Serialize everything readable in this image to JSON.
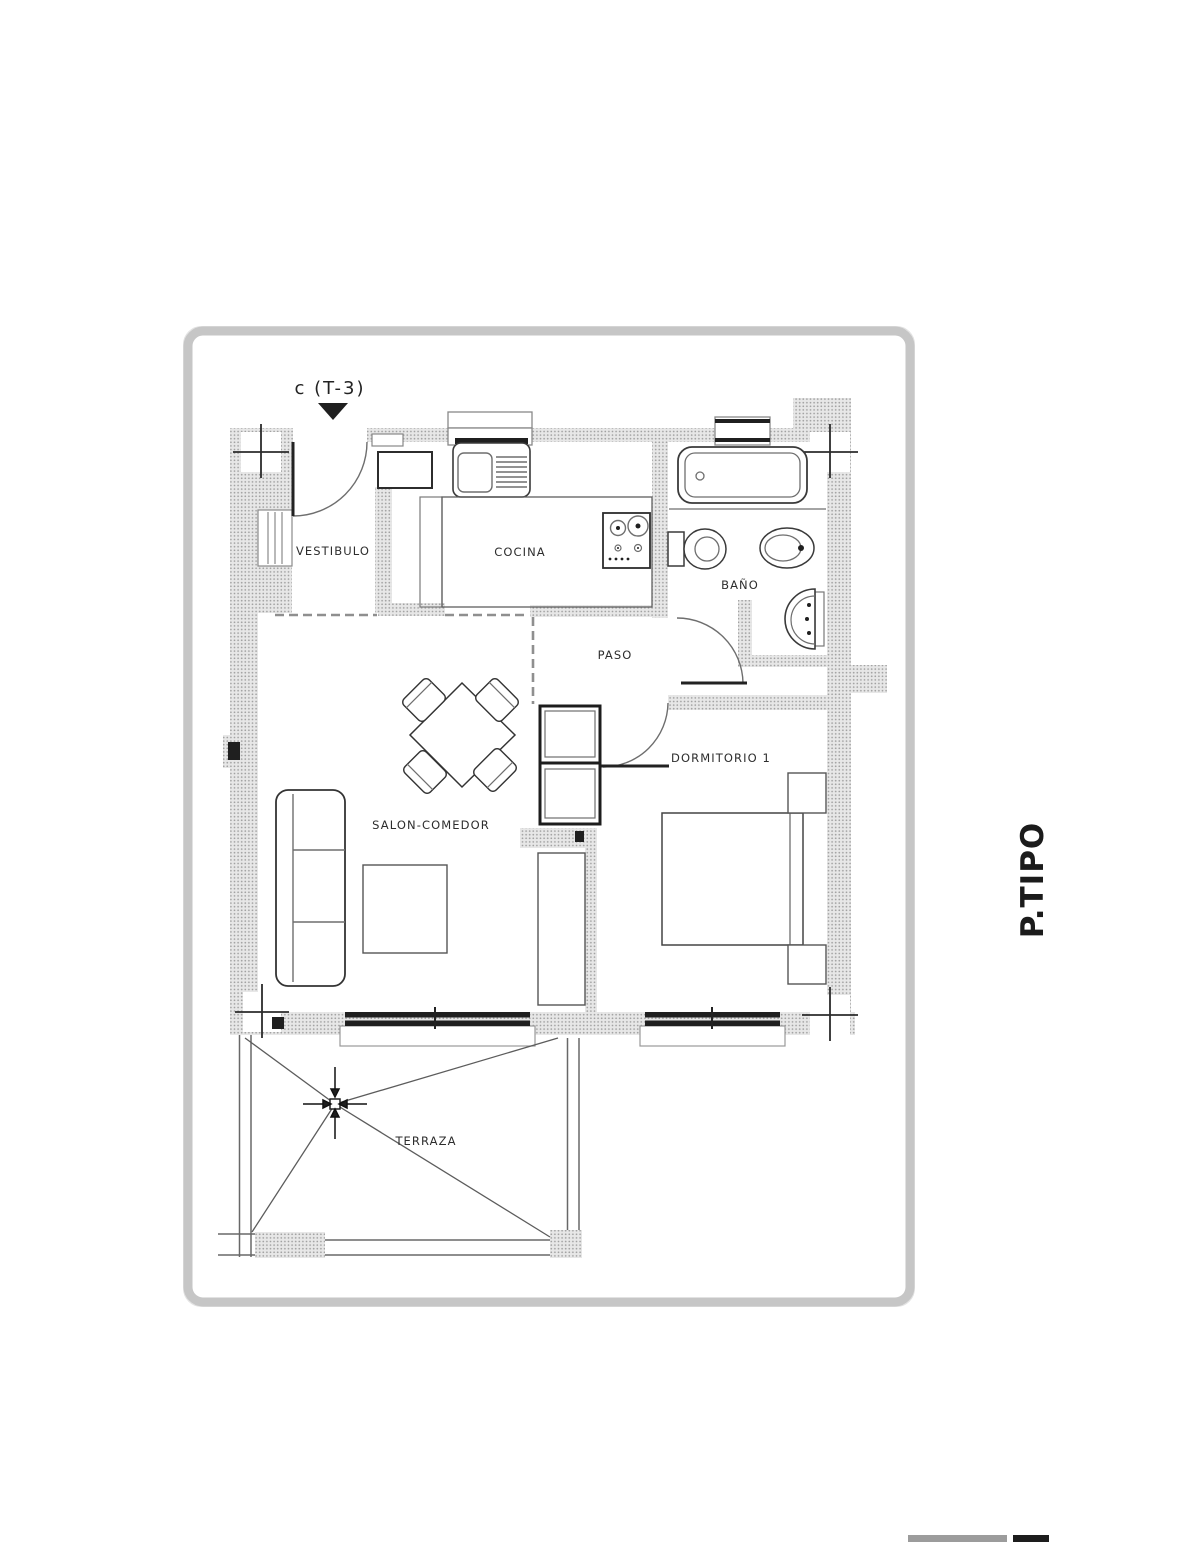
{
  "plan": {
    "entrance_label": "c (T-3)",
    "sheet_label": "P.TIPO",
    "rooms": {
      "vestibulo": "VESTIBULO",
      "cocina": "COCINA",
      "bano": "BAÑO",
      "paso": "PASO",
      "salon": "SALON-COMEDOR",
      "dormitorio": "DORMITORIO 1",
      "terraza": "TERRAZA"
    },
    "colors": {
      "wall_fill": "#e7e7e7",
      "wall_dot": "#a2a2a2",
      "line": "#3a3a3a",
      "label": "#2d2d2d",
      "card_border": "#c6c6c6",
      "footer_gray": "#9c9c9c",
      "footer_black": "#1d1d1d"
    }
  }
}
